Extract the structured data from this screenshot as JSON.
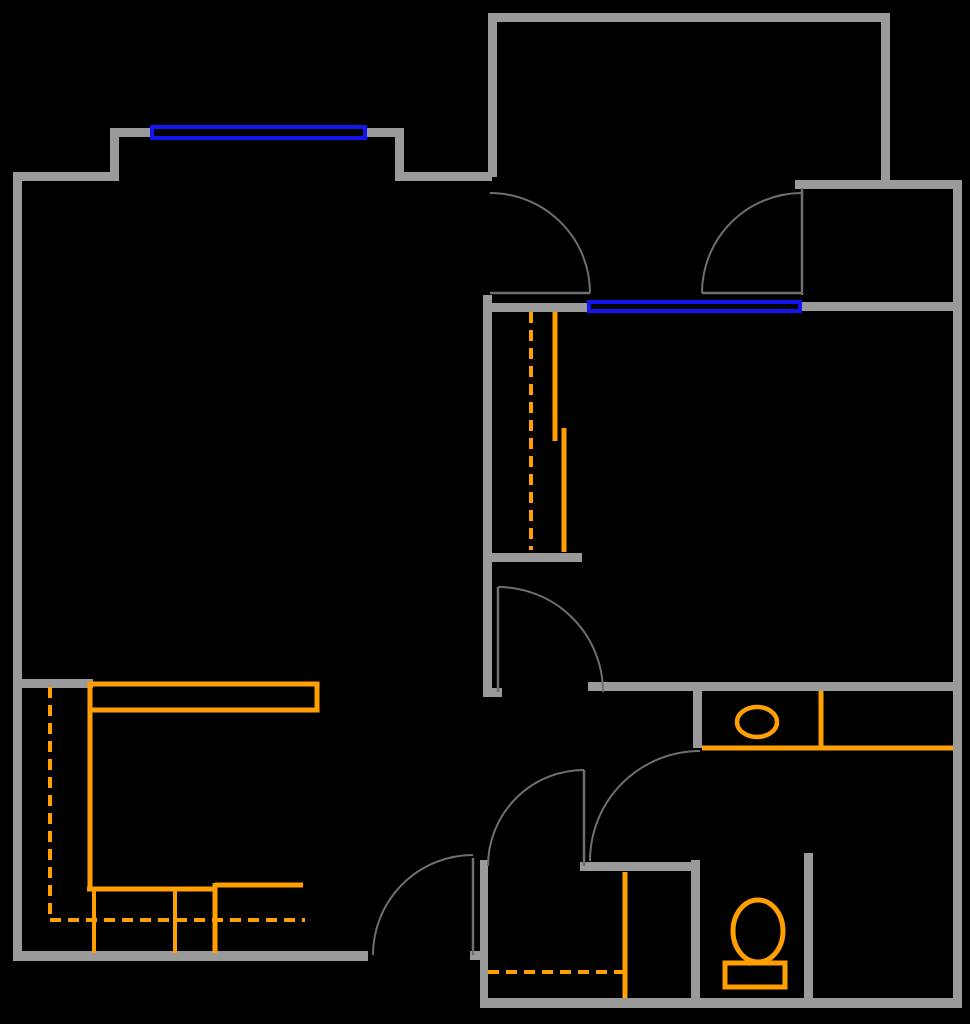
{
  "canvas": {
    "width": 970,
    "height": 1024,
    "background": "#000000"
  },
  "colors": {
    "wall": "#9a9a9a",
    "door_line": "#6f6f6f",
    "window": "#1414f0",
    "fixture": "#ffa000"
  },
  "walls": [
    {
      "name": "wall-left-exterior",
      "x": 13,
      "y": 172,
      "w": 9,
      "h": 789
    },
    {
      "name": "wall-top-left",
      "x": 13,
      "y": 172,
      "w": 97,
      "h": 9
    },
    {
      "name": "wall-bay-left",
      "x": 110,
      "y": 128,
      "w": 9,
      "h": 53
    },
    {
      "name": "wall-bay-top-left",
      "x": 110,
      "y": 128,
      "w": 40,
      "h": 9
    },
    {
      "name": "wall-bay-top-right",
      "x": 367,
      "y": 128,
      "w": 37,
      "h": 9
    },
    {
      "name": "wall-bay-right",
      "x": 395,
      "y": 128,
      "w": 9,
      "h": 53
    },
    {
      "name": "wall-top-mid",
      "x": 402,
      "y": 172,
      "w": 90,
      "h": 9
    },
    {
      "name": "wall-entry-left",
      "x": 488,
      "y": 13,
      "w": 9,
      "h": 164
    },
    {
      "name": "wall-entry-top",
      "x": 488,
      "y": 13,
      "w": 402,
      "h": 9
    },
    {
      "name": "wall-entry-right",
      "x": 881,
      "y": 13,
      "w": 9,
      "h": 168
    },
    {
      "name": "wall-upper-right",
      "x": 795,
      "y": 180,
      "w": 167,
      "h": 9
    },
    {
      "name": "wall-right-exterior",
      "x": 953,
      "y": 180,
      "w": 9,
      "h": 828
    },
    {
      "name": "wall-mid-west",
      "x": 483,
      "y": 303,
      "w": 105,
      "h": 9
    },
    {
      "name": "wall-mid-east",
      "x": 802,
      "y": 302,
      "w": 151,
      "h": 9
    },
    {
      "name": "wall-bedroom-left",
      "x": 483,
      "y": 295,
      "w": 9,
      "h": 397
    },
    {
      "name": "wall-bedroom-left-foot",
      "x": 483,
      "y": 688,
      "w": 19,
      "h": 9
    },
    {
      "name": "wall-closet-bottom",
      "x": 488,
      "y": 553,
      "w": 94,
      "h": 9
    },
    {
      "name": "wall-bedroom-bottom",
      "x": 588,
      "y": 682,
      "w": 365,
      "h": 9
    },
    {
      "name": "wall-bath-stub",
      "x": 693,
      "y": 691,
      "w": 9,
      "h": 57
    },
    {
      "name": "wall-kitchen-stub",
      "x": 22,
      "y": 679,
      "w": 71,
      "h": 9
    },
    {
      "name": "wall-kitchen-bottom",
      "x": 13,
      "y": 951,
      "w": 355,
      "h": 10
    },
    {
      "name": "wall-laundry-left",
      "x": 480,
      "y": 860,
      "w": 8,
      "h": 148
    },
    {
      "name": "wall-kitchen-door-stub",
      "x": 470,
      "y": 951,
      "w": 18,
      "h": 9
    },
    {
      "name": "wall-bottom-exterior",
      "x": 480,
      "y": 998,
      "w": 482,
      "h": 10
    },
    {
      "name": "wall-hall-south",
      "x": 580,
      "y": 862,
      "w": 120,
      "h": 9
    },
    {
      "name": "wall-wc-left",
      "x": 691,
      "y": 860,
      "w": 9,
      "h": 140
    },
    {
      "name": "wall-wc-right",
      "x": 804,
      "y": 853,
      "w": 9,
      "h": 147
    }
  ],
  "windows": [
    {
      "name": "window-living-room",
      "x": 150,
      "y": 125,
      "w": 217,
      "h": 15,
      "stroke": 4
    },
    {
      "name": "window-hall",
      "x": 587,
      "y": 300,
      "w": 215,
      "h": 13,
      "stroke": 4
    }
  ],
  "doors": [
    {
      "name": "living-room-door",
      "leaf": {
        "x1": 490,
        "y1": 293,
        "x2": 590,
        "y2": 293
      },
      "arc": {
        "cx": 490,
        "cy": 293,
        "r": 100,
        "from": 270,
        "to": 360
      }
    },
    {
      "name": "vestibule-door",
      "leaf": {
        "x1": 802,
        "y1": 188,
        "x2": 802,
        "y2": 295
      },
      "line": {
        "x1": 702,
        "y1": 293,
        "x2": 802,
        "y2": 293
      },
      "arc": {
        "cx": 802,
        "cy": 293,
        "r": 100,
        "from": 180,
        "to": 270
      }
    },
    {
      "name": "bedroom-door",
      "leaf": {
        "x1": 498,
        "y1": 587,
        "x2": 498,
        "y2": 692
      },
      "arc": {
        "cx": 498,
        "cy": 692,
        "r": 105,
        "from": 270,
        "to": 360
      }
    },
    {
      "name": "bathroom-door",
      "arc": {
        "cx": 700,
        "cy": 861,
        "r": 110,
        "from": 180,
        "to": 270
      }
    },
    {
      "name": "hall-door",
      "leaf": {
        "x1": 584,
        "y1": 770,
        "x2": 584,
        "y2": 866
      },
      "arc": {
        "cx": 584,
        "cy": 866,
        "r": 96,
        "from": 180,
        "to": 270
      }
    },
    {
      "name": "kitchen-door",
      "leaf": {
        "x1": 473,
        "y1": 858,
        "x2": 473,
        "y2": 955
      },
      "arc": {
        "cx": 473,
        "cy": 955,
        "r": 100,
        "from": 180,
        "to": 270
      }
    }
  ],
  "fixtures": {
    "lines": [
      {
        "name": "kitchen-counter-left",
        "x1": 90,
        "y1": 684,
        "x2": 90,
        "y2": 889,
        "w": 5
      },
      {
        "name": "kitchen-counter-edge-a",
        "x1": 87,
        "y1": 889,
        "x2": 217,
        "y2": 889,
        "w": 5
      },
      {
        "name": "kitchen-counter-edge-b",
        "x1": 215,
        "y1": 885,
        "x2": 303,
        "y2": 885,
        "w": 5
      },
      {
        "name": "kitchen-divider-a",
        "x1": 94,
        "y1": 889,
        "x2": 94,
        "y2": 953,
        "w": 4
      },
      {
        "name": "kitchen-divider-b",
        "x1": 175,
        "y1": 889,
        "x2": 175,
        "y2": 953,
        "w": 4
      },
      {
        "name": "kitchen-divider-c",
        "x1": 215,
        "y1": 883,
        "x2": 215,
        "y2": 953,
        "w": 5
      },
      {
        "name": "closet-shelf-a",
        "x1": 555,
        "y1": 312,
        "x2": 555,
        "y2": 441,
        "w": 5
      },
      {
        "name": "closet-shelf-b",
        "x1": 564,
        "y1": 428,
        "x2": 564,
        "y2": 552,
        "w": 5
      },
      {
        "name": "laundry-cabinet-edge",
        "x1": 625,
        "y1": 872,
        "x2": 625,
        "y2": 998,
        "w": 5
      },
      {
        "name": "vanity-front-edge",
        "x1": 702,
        "y1": 748,
        "x2": 953,
        "y2": 748,
        "w": 5
      },
      {
        "name": "vanity-right-edge",
        "x1": 821,
        "y1": 691,
        "x2": 821,
        "y2": 748,
        "w": 5
      }
    ],
    "dashed_lines": [
      {
        "name": "kitchen-overhead-dashed-v",
        "x1": 50,
        "y1": 687,
        "x2": 50,
        "y2": 918,
        "w": 4
      },
      {
        "name": "kitchen-overhead-dashed-h",
        "x1": 50,
        "y1": 920,
        "x2": 305,
        "y2": 920,
        "w": 4
      },
      {
        "name": "closet-rod-dashed",
        "x1": 531,
        "y1": 312,
        "x2": 531,
        "y2": 550,
        "w": 4
      },
      {
        "name": "laundry-overhead-dashed",
        "x1": 488,
        "y1": 972,
        "x2": 625,
        "y2": 972,
        "w": 4
      }
    ],
    "rects": [
      {
        "name": "kitchen-counter-top",
        "x": 90,
        "y": 684,
        "w": 227,
        "h": 26,
        "stroke": 5
      },
      {
        "name": "toilet-tank",
        "x": 725,
        "y": 963,
        "w": 60,
        "h": 24,
        "stroke": 5
      }
    ],
    "ellipses": [
      {
        "name": "bathroom-sink",
        "cx": 757,
        "cy": 722,
        "rx": 20,
        "ry": 15,
        "stroke": 4.5
      },
      {
        "name": "toilet-bowl",
        "cx": 758,
        "cy": 931,
        "rx": 25,
        "ry": 31,
        "stroke": 5
      }
    ]
  }
}
